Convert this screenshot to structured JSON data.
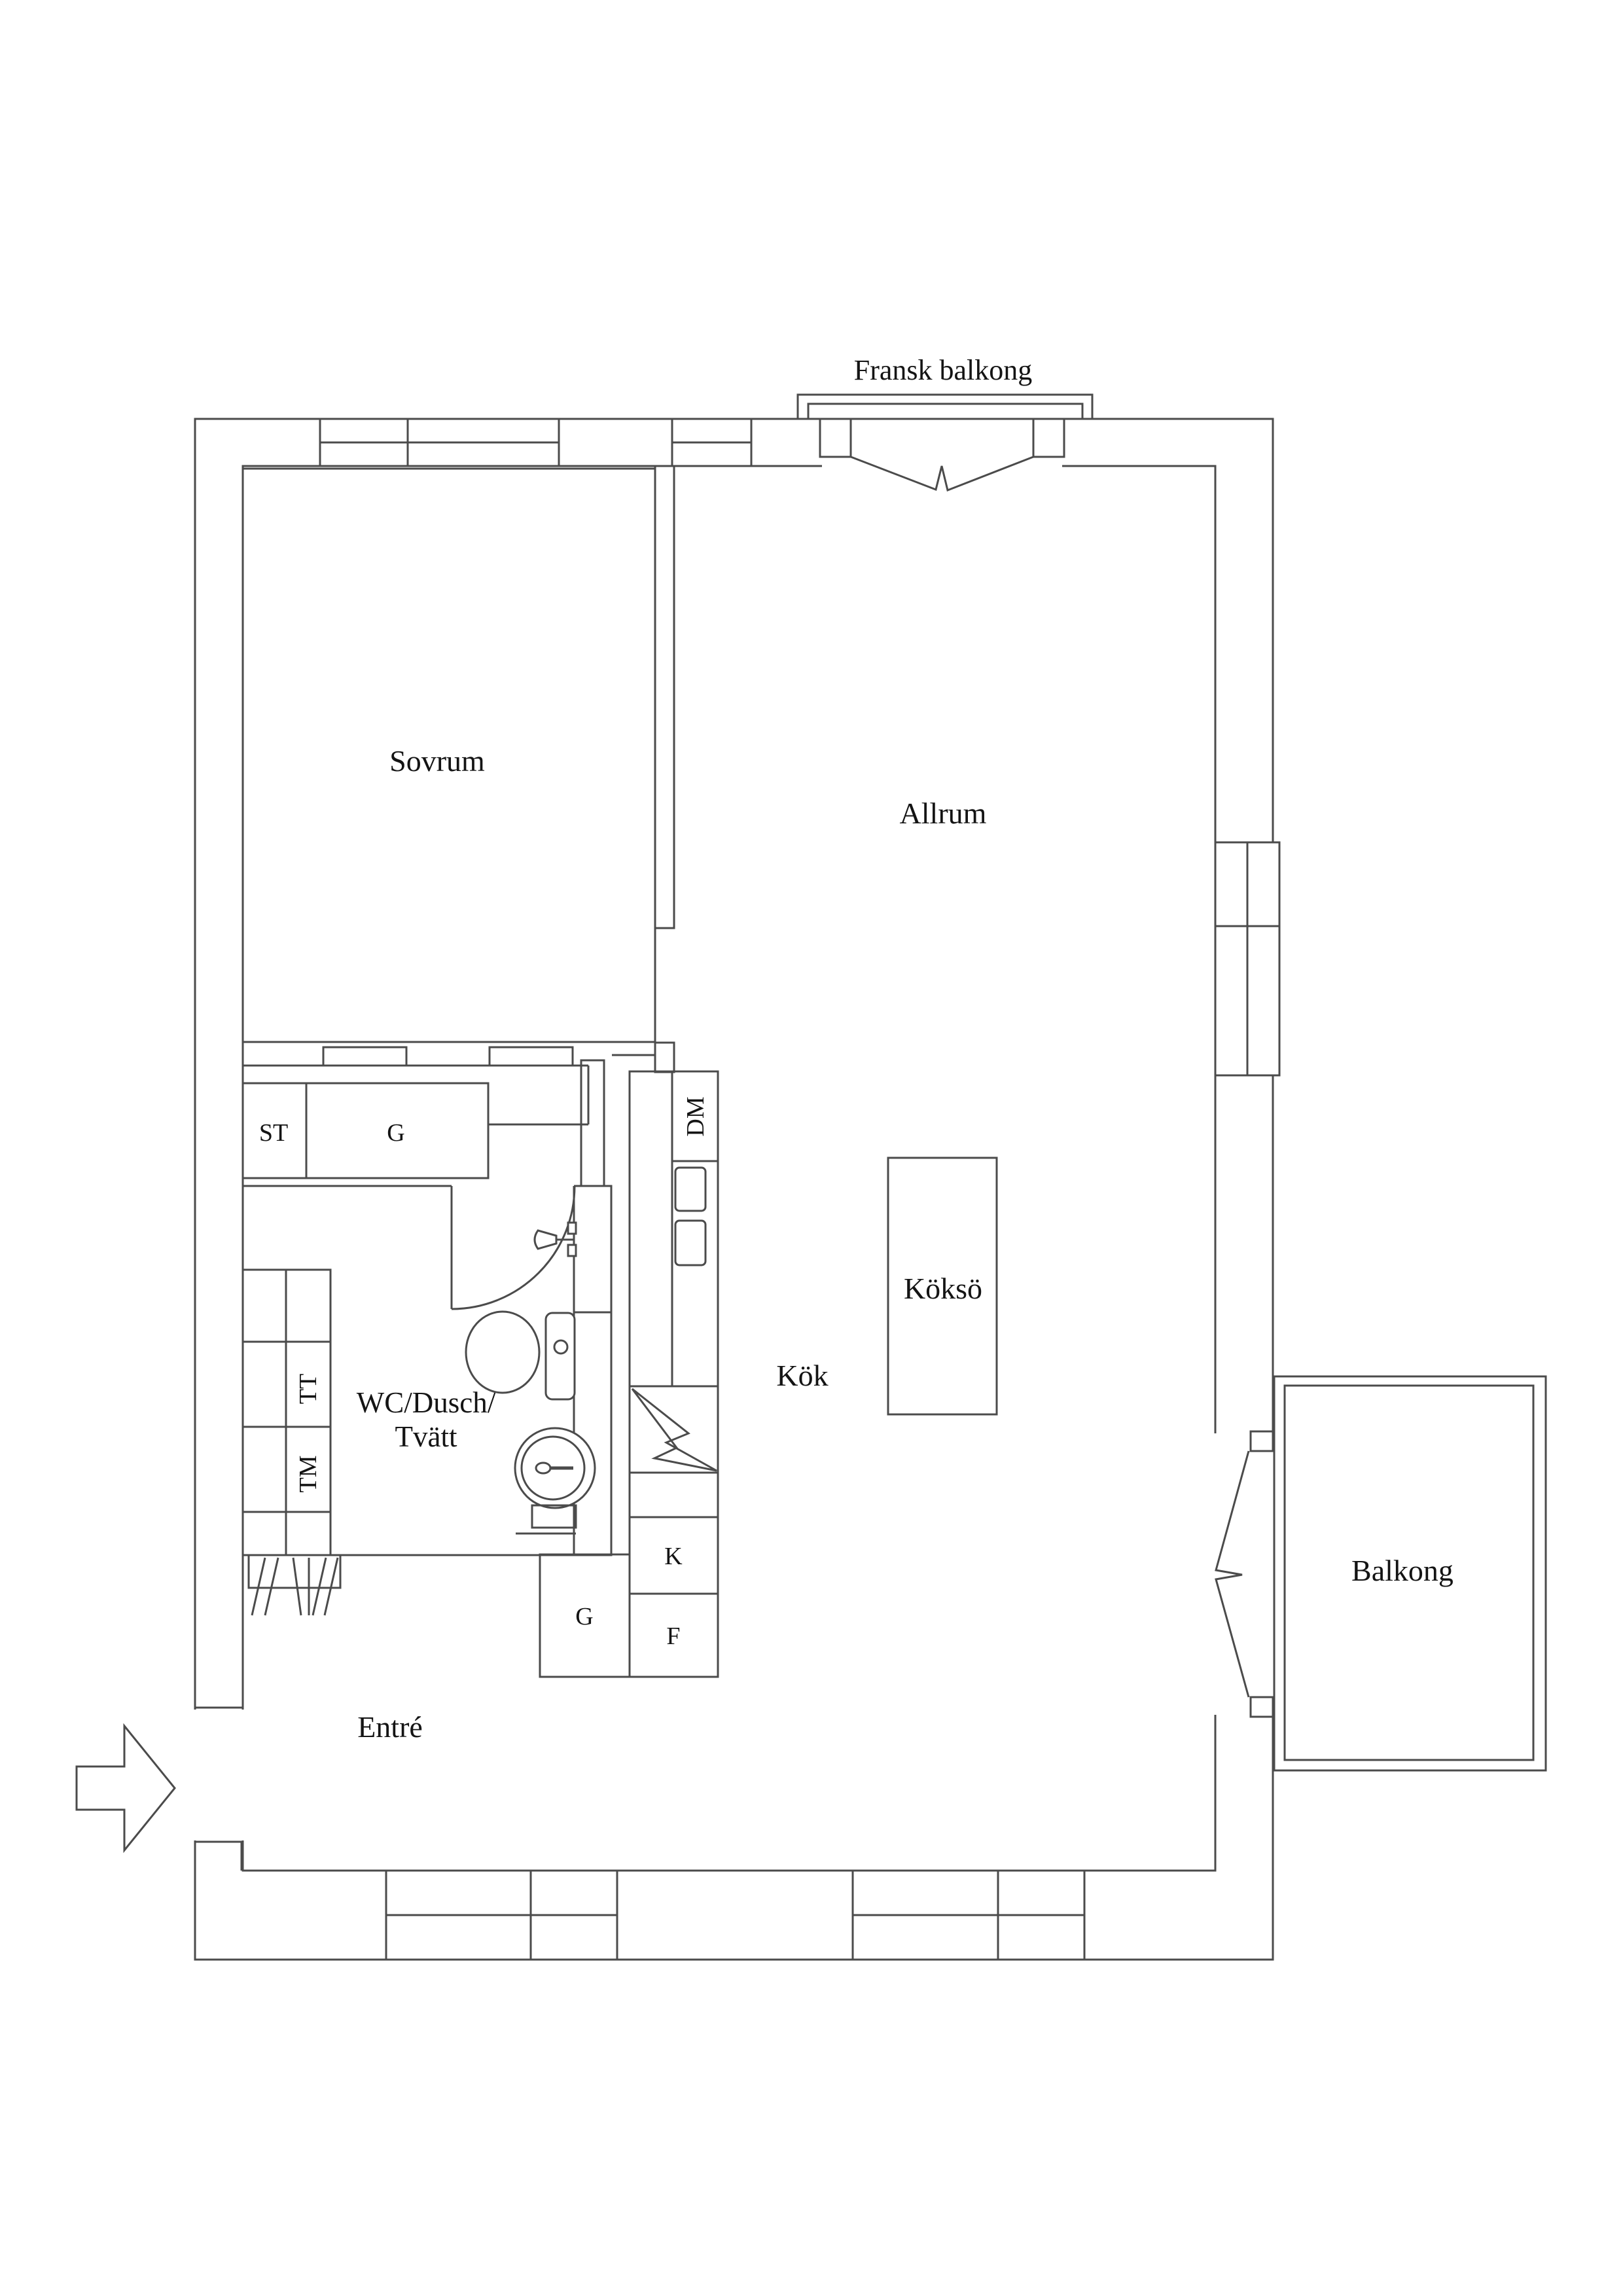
{
  "plan": {
    "type": "floor-plan",
    "language": "Swedish",
    "colors": {
      "line": "#4b4b4b",
      "text": "#141414",
      "background": "#ffffff"
    },
    "labels": {
      "fransk_balkong": "Fransk balkong",
      "sovrum": "Sovrum",
      "allrum": "Allrum",
      "st": "ST",
      "g_wardrobe": "G",
      "dm": "DM",
      "tt": "TT",
      "tm": "TM",
      "wc_line1": "WC/Dusch/",
      "wc_line2": "Tvätt",
      "kok": "Kök",
      "kokso": "Köksö",
      "kyl": "K",
      "frys": "F",
      "g_hall": "G",
      "balkong": "Balkong",
      "entre": "Entré"
    }
  }
}
